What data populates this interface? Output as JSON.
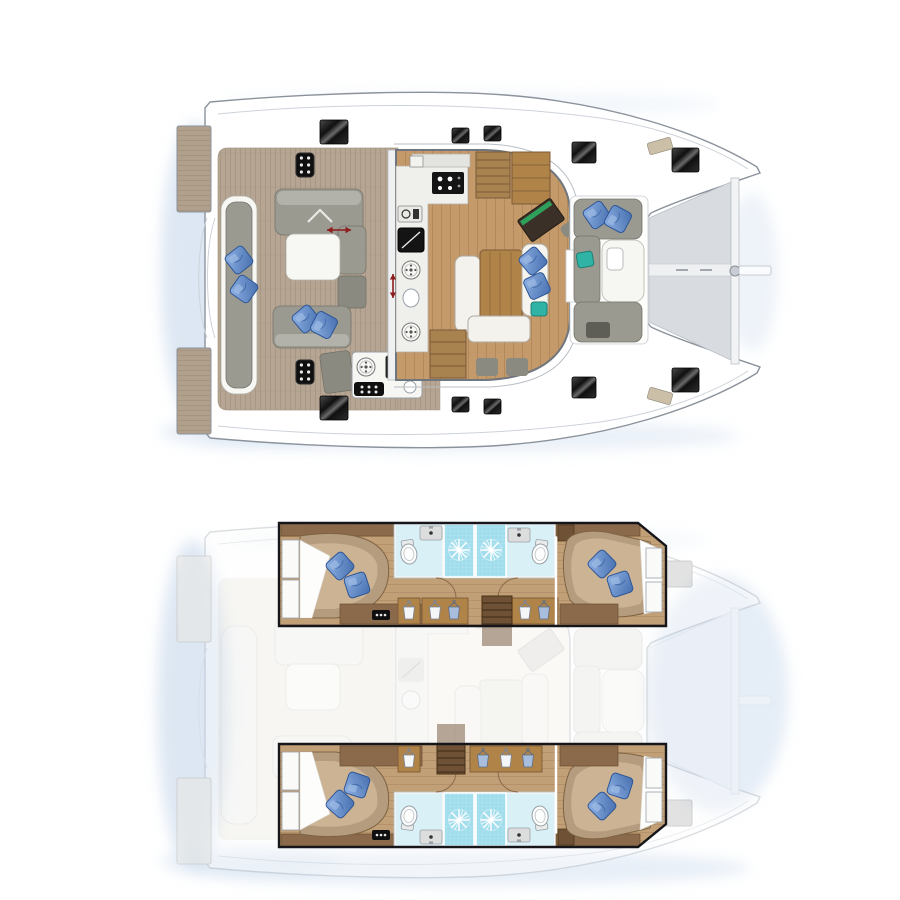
{
  "document": {
    "type": "yacht-layout-illustration",
    "subject": "catamaran floor plan, two stacked plan views, bow pointing right",
    "views": [
      {
        "id": "upper-deck",
        "label": "main deck plan"
      },
      {
        "id": "lower-deck",
        "label": "hull accommodations plan with ghosted deck overlay"
      }
    ]
  },
  "colors": {
    "pageBg": "#ffffff",
    "hullLine": "#8b929c",
    "seam": "#cdd3da",
    "shadow": "#c6d7eb",
    "teak": "#b5a592",
    "teakLine": "#9c8c78",
    "tramp": "#d8dce1",
    "trampLine": "#b9bec6",
    "cushGray": "#9b9a91",
    "cushLight": "#b3b2aa",
    "padWhite": "#f7f7f4",
    "salonWood": "#c49a6b",
    "salonWoodLine": "#a87e50",
    "woodMid": "#b08449",
    "woodDark": "#7c5a38",
    "stairsWood": "#6f5136",
    "counter": "#efefec",
    "applianceBlack": "#141414",
    "navDark": "#3a3027",
    "navGreen": "#2fa05c",
    "pillowBlue": "#6b97d6",
    "pillowDeep": "#3c66a8",
    "teal": "#2fb3a4",
    "bathFloor": "#d8f0f6",
    "shower": "#9fdcec",
    "redArrow": "#8e1d1d",
    "cabinWood": "#b59c7e",
    "cabinWoodLight": "#cdb697",
    "cabinTrim": "#8a6a4a",
    "corridorWood": "#c2a077",
    "corridorLine": "#a3805c",
    "boxBlack": "#15151a",
    "ghostInk": "#a9b0b8",
    "bowHatchGray": "#c6c6c6"
  },
  "upper_deck": {
    "features": [
      "swim-platforms",
      "aft-cockpit-lounge",
      "cockpit-table",
      "outdoor-galley",
      "salon-galley",
      "chart-table",
      "dining-table",
      "companionway-stairs",
      "forward-cockpit-lounge",
      "trampoline",
      "bowsprit",
      "deck-hatches",
      "slide-direction-arrows"
    ]
  },
  "lower_deck": {
    "features": [
      "aft-cabin-berth-x2",
      "shower-room-pair-per-hull",
      "toilets",
      "sinks",
      "wardrobes-with-hangers",
      "forward-cabin-berth-x2",
      "hull-stairs",
      "ghosted-main-deck",
      "bow-deck-hatches"
    ]
  },
  "icons": [
    "deck-hatch",
    "blue-pillow",
    "burner",
    "shower-drain-starburst",
    "clothes-hanger",
    "toilet",
    "sink",
    "door-swing-arc",
    "red-slide-arrow",
    "windlass",
    "vent-grille",
    "microwave",
    "cooktop",
    "coffee-machine"
  ]
}
